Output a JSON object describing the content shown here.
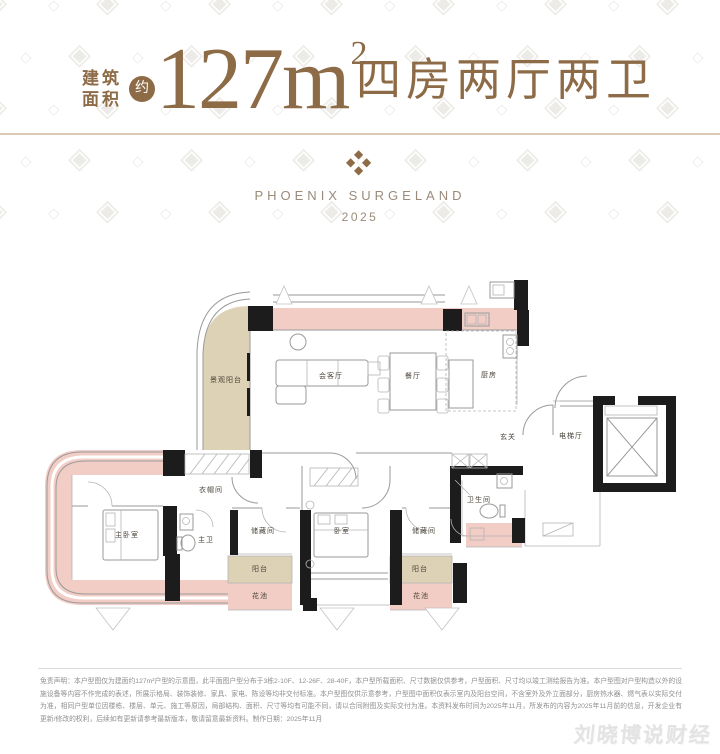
{
  "colors": {
    "brand_brown": "#8d6b47",
    "text_gray_brown": "#9a8b7a",
    "wall_pink": "#f2cdc6",
    "balcony_beige": "#ded2b6",
    "wall_black": "#1c1c1c"
  },
  "decor": {
    "pattern_glyphs": [
      "◈",
      "◇"
    ]
  },
  "header": {
    "area_label_line1": "建筑",
    "area_label_line2": "面积",
    "approx_badge": "约",
    "area_value": "127m",
    "area_unit_sup": "2",
    "layout_text": "四房两厅两卫"
  },
  "brand": {
    "ornament_glyph": "◆",
    "name": "PHOENIX SURGELAND",
    "year": "2025"
  },
  "floor_plan": {
    "rooms": [
      {
        "label": "景观阳台"
      },
      {
        "label": "会客厅"
      },
      {
        "label": "餐厅"
      },
      {
        "label": "厨房"
      },
      {
        "label": "玄关"
      },
      {
        "label": "电梯厅"
      },
      {
        "label": "衣帽间"
      },
      {
        "label": "主卧室"
      },
      {
        "label": "主卫"
      },
      {
        "label": "储藏间"
      },
      {
        "label": "阳台"
      },
      {
        "label": "花池"
      },
      {
        "label": "卧室"
      },
      {
        "label": "储藏间"
      },
      {
        "label": "阳台"
      },
      {
        "label": "花池"
      },
      {
        "label": "卫生间"
      }
    ]
  },
  "disclaimer": {
    "text": "免责声明：本户型图仅为建面约127m²户型的示意图，此平面图户型分布于3栋2-10F、12-26F、28-40F，本户型所载面积、尺寸数据仅供参考，户型面积、尺寸均以竣工测绘报告为准。本户型图对户型构造以外的设施设备等内容不作完成的表述，所展示格局、装饰装修、家具、家电、陈设等均非交付标准。本户型图仅供示意参考，户型图中面积仅表示室内及阳台空间，不含室外及外立面部分，厨房热水器、燃气表以实际交付为准，相同户型单位因楼栋、楼层、单元、施工等原因，局部结构、面积、尺寸等均有可能不同，请以合同附图及实际交付为准。本资料发布时间为2025年11月，所发布的内容为2025年11月前的信息，开发企业有更新/修改的权利，后续如有更新请参考最新版本，敬请留意最新资料。制作日期：2025年11月"
  },
  "watermark": {
    "text": "刘晓博说财经"
  }
}
